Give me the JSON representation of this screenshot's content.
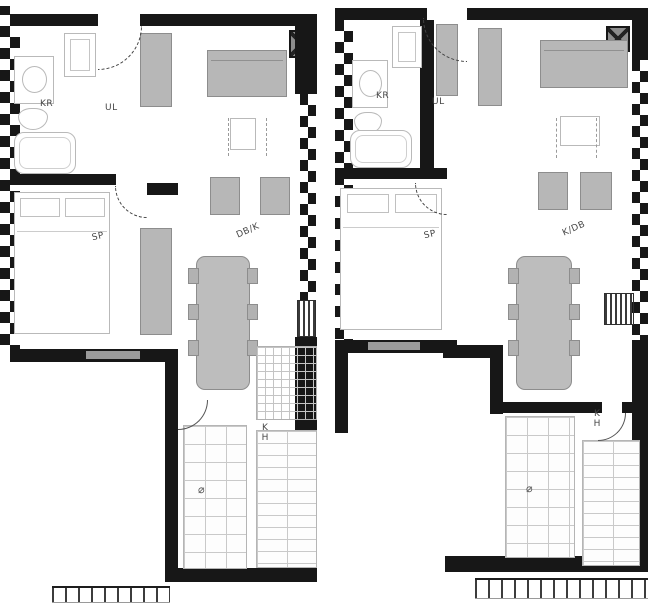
{
  "document": {
    "type": "architectural floor plan",
    "units_count": 2
  },
  "colors": {
    "wall": "#171717",
    "furniture_fill": "#b7b7b7",
    "furniture_border": "#8d8d8d",
    "light_line": "#b9b9b9",
    "tile_line": "#c9c9c9",
    "label_text": "#474747",
    "background": "#ffffff"
  },
  "units": [
    {
      "name": "left-unit",
      "labels": {
        "bathroom": "KR",
        "hall": "UL",
        "bedroom": "SP",
        "living_kitchen": "DB/K",
        "bath_kitchen": "KH",
        "drain_symbol": "⌀"
      }
    },
    {
      "name": "right-unit",
      "labels": {
        "bathroom": "KR",
        "hall": "UL",
        "bedroom": "SP",
        "living_kitchen": "K/DB",
        "bath_kitchen": "KH",
        "drain_symbol": "⌀"
      }
    }
  ]
}
